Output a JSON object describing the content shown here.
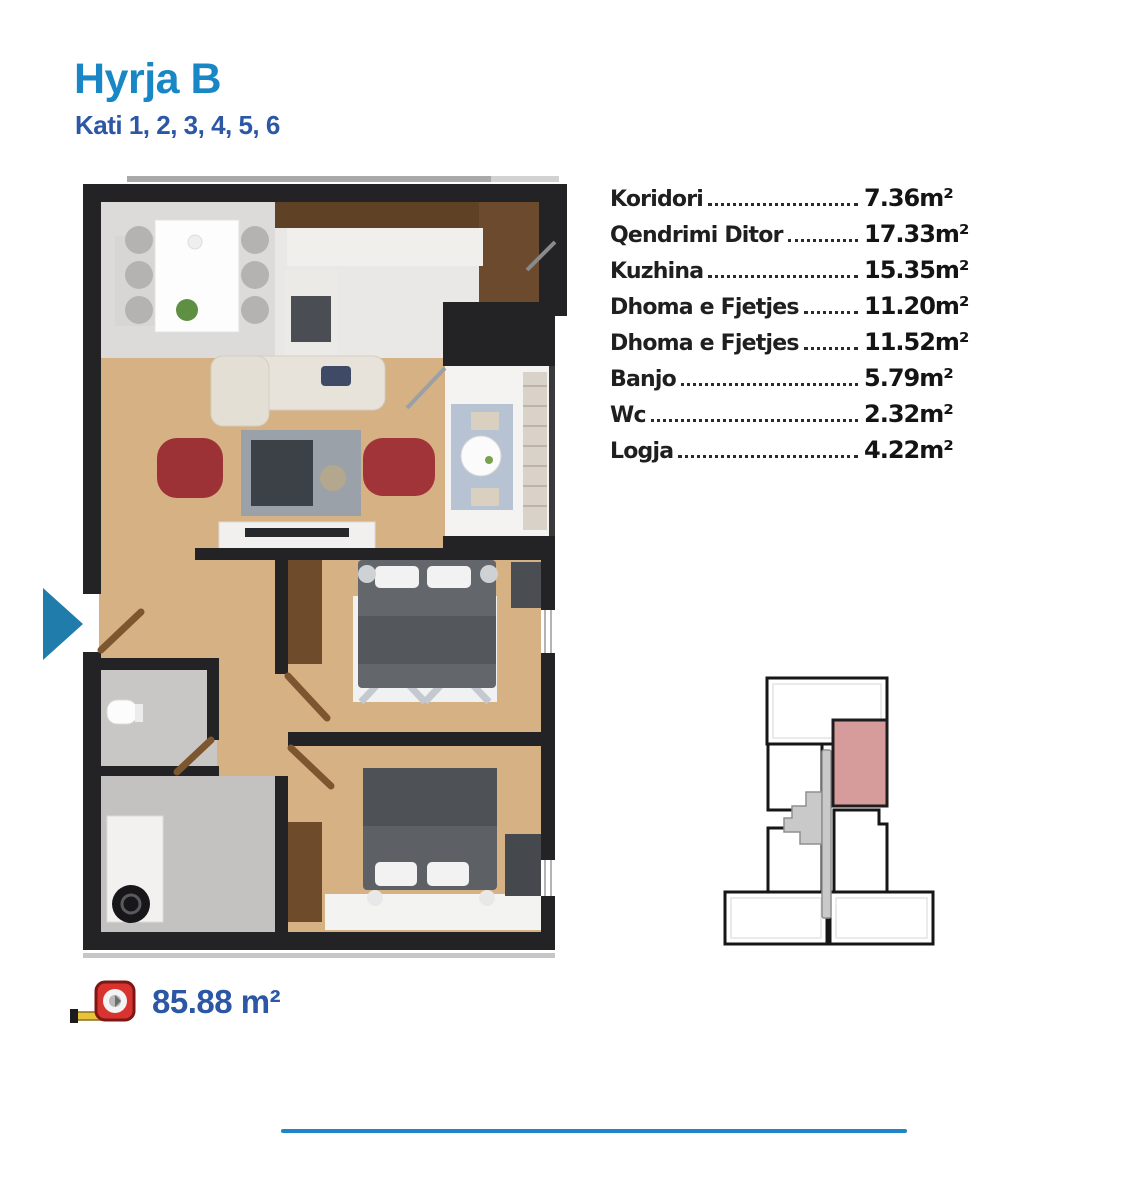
{
  "page": {
    "background": "#ffffff"
  },
  "header": {
    "title": "Hyrja B",
    "subtitle": "Kati 1, 2, 3, 4, 5, 6",
    "title_color": "#1987c5",
    "subtitle_color": "#2c57a5"
  },
  "floor_plan": {
    "description": "apartment-top-view-floor-plan",
    "entrance_arrow_color": "#1f7cab"
  },
  "room_list": {
    "text_color": "#1f1f1f",
    "rooms": [
      {
        "name": "Koridori",
        "area": "7.36m²"
      },
      {
        "name": "Qendrimi Ditor",
        "area": "17.33m²"
      },
      {
        "name": "Kuzhina",
        "area": "15.35m²"
      },
      {
        "name": "Dhoma e Fjetjes",
        "area": "11.20m²"
      },
      {
        "name": "Dhoma e Fjetjes",
        "area": "11.52m²"
      },
      {
        "name": "Banjo",
        "area": "5.79m²"
      },
      {
        "name": "Wc",
        "area": "2.32m²"
      },
      {
        "name": "Logja",
        "area": "4.22m²"
      }
    ]
  },
  "total_area": {
    "icon": "tape-measure-icon",
    "value": "85.88 m²",
    "color": "#2c57a5"
  },
  "mini_map": {
    "highlight_color": "#d69c9c",
    "core_color": "#c9c9c9",
    "outline_color": "#161616"
  },
  "divider": {
    "color": "#1e86c8"
  }
}
